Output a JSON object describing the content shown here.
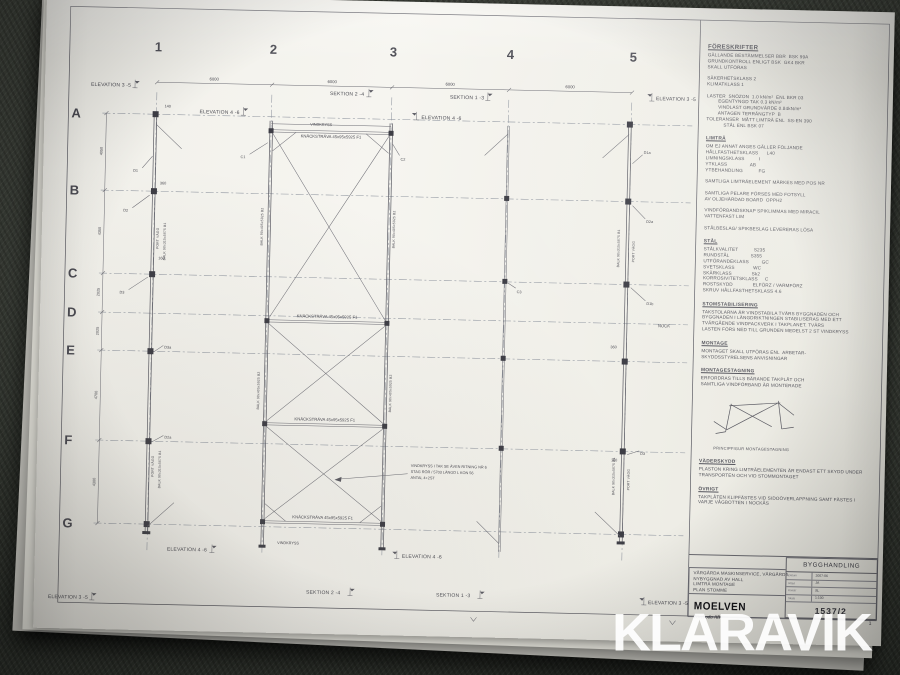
{
  "photo": {
    "watermark": "KLARAVIK"
  },
  "plan": {
    "grid_numbers": [
      "1",
      "2",
      "3",
      "4",
      "5"
    ],
    "grid_letters": [
      "A",
      "B",
      "C",
      "D",
      "E",
      "F",
      "G"
    ],
    "bay_dim": "6000",
    "left_dims": [
      "4050",
      "4350",
      "2025",
      "2025",
      "4700",
      "4300"
    ],
    "small_dims": [
      "140",
      "360",
      "160",
      "360",
      "160"
    ],
    "labels": {
      "elevation_35": "ELEVATION 3 -5",
      "elevation_46": "ELEVATION 4 -6",
      "sektion_24": "SEKTION 2 -4",
      "sektion_13": "SEKTION 1 -3",
      "vindkryss": "VINDKRYSS",
      "knackstrava": "KNÄCKSTRÄVA 45x95x5925  F1",
      "balk_b1": "BALK 90x315x5675  B1",
      "balk_b2": "BALK 90x405x5925  B2",
      "port_vagg": "PORT VÄGG",
      "nock": "NOCK"
    },
    "callouts": {
      "c1": "C1",
      "c2": "C2",
      "c3": "C3",
      "d1": "D1",
      "d1a": "D1a",
      "d1b": "D1b",
      "d2": "D2",
      "d2a": "D2a",
      "d3": "D3",
      "d3a": "D3a"
    },
    "annotation": [
      "VINDKRYSS I TAK SE ÄVEN RITNING NR 6",
      "STAG RÖR / 5703 LÄNGD L KON 56",
      "ANTAL 4+2ST"
    ]
  },
  "notes": {
    "sections": [
      {
        "title": "FÖRESKRIFTER",
        "lines": [
          "GÄLLANDE BESTÄMMELSER BBR  BSK 99A",
          "GRUNDKONTROLL ENLIGT BSK  GK4 BKR",
          "SKALL UTFÖRAS",
          "",
          "SÄKERHETSKLASS 2",
          "KLIMATKLASS 1",
          "",
          "LASTER  SNÖZON  1.0 kN/m²  ENL BKR 03",
          "        EGENTYNGD TAK 0.3 kN/m²",
          "        VINDLAST GRUNDVÄRDE 0.84kN/m²",
          "        ANTAGEN TERRÄNGTYP  B",
          "TOLERANSER  MÅTT LIMTRÄ ENL  SS-EN 390",
          "            STÅL ENL BSK 07"
        ]
      },
      {
        "title": "LIMTRÄ",
        "lines": [
          "OM EJ ANNAT ANGES GÄLLER FÖLJANDE",
          "HÅLLFASTHETSKLASS      L40",
          "LIMNINGSKLASS          I",
          "YTKLASS                AB",
          "YTBEHANDLING           FG",
          "",
          "SAMTLIGA LIMTRÄELEMENT MÄRKES MED POS NR",
          "",
          "SAMTLIGA PELARE FÖRSES MED FOTSYLL",
          "AV OLJEHÄRDAD BOARD  OPPH2",
          "",
          "VINDFÖRBANDSKNAP SPIKLIMMAS MED MIRACIL",
          "VATTENFAST LIM",
          "",
          "STÅLBESLAG/ SPIKBESLAG LEVERERAS LÖSA"
        ]
      },
      {
        "title": "STÅL",
        "lines": [
          "STÅLKVALITET           S235",
          "RUNDSTÅL               S355",
          "UTFÖRANDEKLASS         GC",
          "SVETSKLASS             WC",
          "SKÄRKLASS              Sk2",
          "KORROSIVITETSKLASS     C",
          "ROSTSKYDD              ELFÖRZ / VARMFÖRZ",
          "SKRUV HÅLLFASTHETSKLASS 4.6"
        ]
      },
      {
        "title": "STOMSTABILISERING",
        "lines": [
          "TAKSTOLARNA ÄR VINDSTABILA TVÄRS BYGGNADEN OCH",
          "BYGGNADEN I LÄNGDRIKTNINGEN STABILISERAS MED ETT",
          "TVÄRGÅENDE VINDFACKVERK I TAKPLANET. TVÄRS",
          "LASTEN FÖRS NED TILL GRUNDEN MEDELST 2 ST VINDKRYSS"
        ]
      },
      {
        "title": "MONTAGE",
        "lines": [
          "MONTAGET SKALL UTFÖRAS ENL  ARBETAR-",
          "SKYDDSSTYRELSENS ANVISNINGAR"
        ]
      },
      {
        "title": "MONTAGESTAGNING",
        "lines": [
          "ERFORDRAS TILLS BÄRANDE TAKPLÅT OCH",
          "SAMTLIGA VINDFÖRBAND ÄR MONTERADE"
        ]
      },
      {
        "title": "VÄDERSKYDD",
        "lines": [
          "PLASTON KRING LIMTRÄELEMENTEN ÄR ENDAST ETT SKYDD UNDER",
          "TRANSPORTEN OCH VID STOMMONTAGET"
        ]
      },
      {
        "title": "ÖVRIGT",
        "lines": [
          "TAKPLÅTEN KLIPFÄSTES VID SIDOÖVERLAPPNING SAMT FÄSTES I",
          "VARJE VÅGBOTTEN I NOCKÅS"
        ]
      }
    ],
    "figure_caption": "PRINCIPFIGUR MONTAGESTAGNING"
  },
  "title_block": {
    "stamp": "BYGGHANDLING",
    "project": [
      "VÅRGÅRDA MASKINSERVICE, VÅRGÅRDA",
      "NYBYGGNAD AV HALL",
      "LIMTRÄ MONTAGE",
      "PLAN STOMME"
    ],
    "logo": "MOELVEN",
    "logo_sub": "Töreboda AB",
    "fields": [
      {
        "label": "Datum",
        "value": "2007-06"
      },
      {
        "label": "Ritad",
        "value": "JA"
      },
      {
        "label": "Konstr",
        "value": "SL"
      },
      {
        "label": "Skala",
        "value": "1:100"
      }
    ],
    "drawing_number": "1537/2",
    "sheet": "1"
  }
}
